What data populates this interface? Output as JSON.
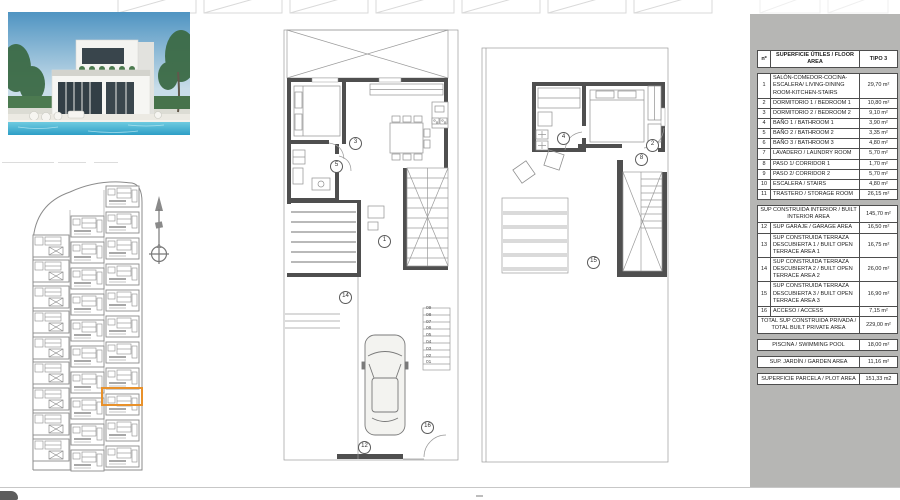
{
  "sheet": {
    "table": {
      "header": {
        "num": "nº",
        "desc": "SUPERFICIE ÚTILES / FLOOR AREA",
        "tipo": "TIPO 3"
      },
      "rows": [
        {
          "n": "1",
          "desc": "SALÓN-COMEDOR-COCINA-ESCALERA/ LIVING-DINING ROOM-KITCHEN-STAIRS",
          "area": "29,70 m²"
        },
        {
          "n": "2",
          "desc": "DORMITORIO 1 / BEDROOM 1",
          "area": "10,80 m²"
        },
        {
          "n": "3",
          "desc": "DORMITORIO 2 / BEDROOM 2",
          "area": "9,10 m²"
        },
        {
          "n": "4",
          "desc": "BAÑO 1 / BATHROOM 1",
          "area": "3,90 m²"
        },
        {
          "n": "5",
          "desc": "BAÑO 2 / BATHROOM 2",
          "area": "3,35 m²"
        },
        {
          "n": "6",
          "desc": "BAÑO 3 / BATHROOM 3",
          "area": "4,80 m²"
        },
        {
          "n": "7",
          "desc": "LAVADERO / LAUNDRY ROOM",
          "area": "5,70 m²"
        },
        {
          "n": "8",
          "desc": "PASO 1/ CORRIDOR 1",
          "area": "1,70 m²"
        },
        {
          "n": "9",
          "desc": "PASO 2/ CORRIDOR 2",
          "area": "5,70 m²"
        },
        {
          "n": "10",
          "desc": "ESCALERA / STAIRS",
          "area": "4,80 m²"
        },
        {
          "n": "11",
          "desc": "TRASTERO / STORAGE ROOM",
          "area": "26,15 m²"
        }
      ],
      "subtotal": {
        "desc": "SUP CONSTRUIDA INTERIOR / BUILT INTERIOR AREA",
        "area": "145,70 m²"
      },
      "rows2": [
        {
          "n": "12",
          "desc": "SUP GARAJE / GARAGE AREA",
          "area": "16,50 m²"
        },
        {
          "n": "13",
          "desc": "SUP CONSTRUIDA TERRAZA DESCUBIERTA 1 / BUILT OPEN TERRACE AREA 1",
          "area": "16,75 m²"
        },
        {
          "n": "14",
          "desc": "SUP CONSTRUIDA TERRAZA DESCUBIERTA 2 / BUILT OPEN TERRACE AREA 2",
          "area": "26,00 m²"
        },
        {
          "n": "15",
          "desc": "SUP CONSTRUIDA TERRAZA DESCUBIERTA 3 / BUILT OPEN TERRACE AREA 3",
          "area": "16,90 m²"
        },
        {
          "n": "16",
          "desc": "ACCESO / ACCESS",
          "area": "7,15 m²"
        }
      ],
      "total": {
        "desc": "TOTAL SUP CONSTRUIDA PRIVADA / TOTAL BUILT PRIVATE AREA",
        "area": "229,00 m²"
      },
      "extras": [
        {
          "desc": "PISCINA / SWIMMING POOL",
          "area": "18,00 m²"
        },
        {
          "desc": "SUP. JARDÍN / GARDEN AREA",
          "area": "11,16 m²"
        },
        {
          "desc": "SUPERFICIE PARCELA / PLOT AREA",
          "area": "151,33 m2"
        }
      ]
    },
    "plans": {
      "ground_markers": [
        {
          "n": "3"
        },
        {
          "n": "5"
        },
        {
          "n": "1"
        },
        {
          "n": "14"
        },
        {
          "n": "12"
        },
        {
          "n": "16"
        }
      ],
      "first_markers": [
        {
          "n": "4"
        },
        {
          "n": "2"
        },
        {
          "n": "8"
        },
        {
          "n": "15"
        }
      ],
      "stair_steps": [
        "09",
        "08",
        "07",
        "06",
        "05",
        "04",
        "03",
        "02",
        "01"
      ]
    },
    "colors": {
      "highlight": "#e8912b",
      "panel_grey": "#b6b6b4",
      "wall": "#4f4f4f",
      "thin_line": "#999999"
    }
  }
}
